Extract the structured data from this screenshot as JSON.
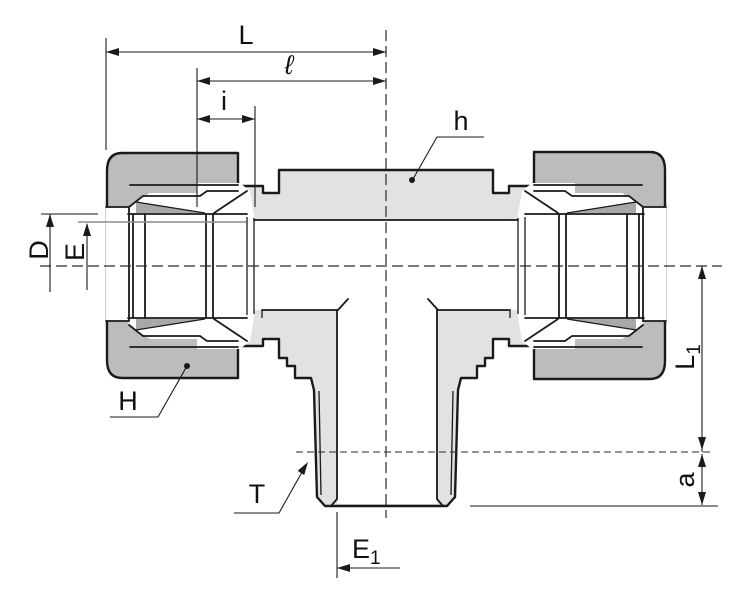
{
  "drawing": {
    "kind": "technical-dimension-drawing",
    "subject": "tube-fitting male branch tee cross-section",
    "labels": {
      "L": "L",
      "ell": "ℓ",
      "i": "i",
      "h": "h",
      "D": "D",
      "E": "E",
      "H": "H",
      "T": "T",
      "E1": {
        "base": "E",
        "sub": "1"
      },
      "L1": {
        "base": "L",
        "sub": "1"
      },
      "a": "a"
    },
    "colors": {
      "background": "#ffffff",
      "body_fill": "#e2e2e2",
      "nut_fill": "#bcbcbc",
      "shadow_fill": "#a8a8a8",
      "bore_fill": "#ffffff",
      "line": "#1a1a1a",
      "reference_line": "#8c8c8c"
    }
  }
}
